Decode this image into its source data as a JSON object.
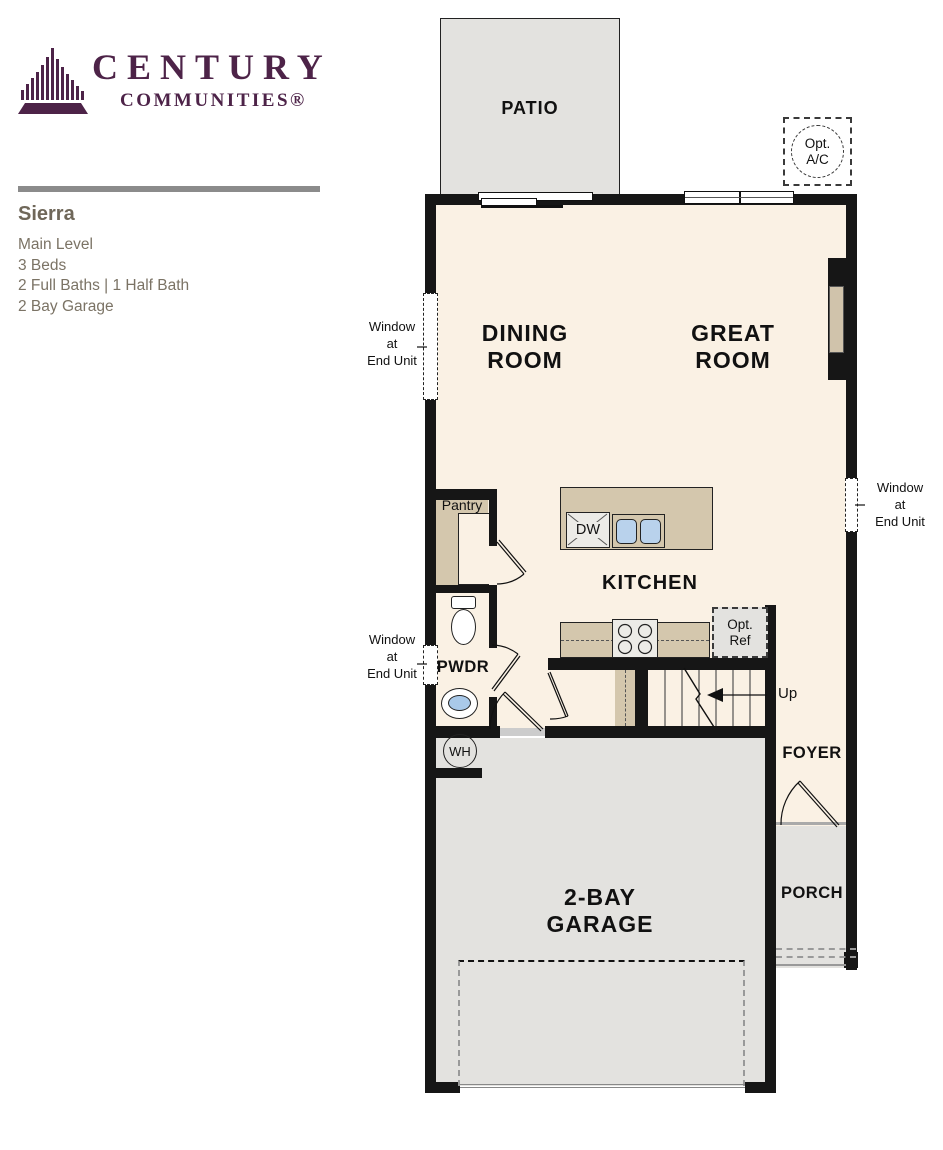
{
  "brand": {
    "line1": "CENTURY",
    "line2": "COMMUNITIES®"
  },
  "plan_info": {
    "title": "Sierra",
    "level": "Main Level",
    "beds": "3 Beds",
    "baths": "2 Full Baths | 1 Half Bath",
    "garage": "2 Bay Garage"
  },
  "rooms": {
    "patio": "PATIO",
    "dining": [
      "DINING",
      "ROOM"
    ],
    "great": [
      "GREAT",
      "ROOM"
    ],
    "kitchen": "KITCHEN",
    "pantry": "Pantry",
    "powder": "PWDR",
    "foyer": "FOYER",
    "porch": "PORCH",
    "garage": [
      "2-BAY",
      "GARAGE"
    ]
  },
  "annotations": {
    "opt_ac": [
      "Opt.",
      "A/C"
    ],
    "opt_ref": [
      "Opt.",
      "Ref"
    ],
    "dishwasher": "DW",
    "water_heater": "WH",
    "stairs_up": "Up",
    "window_end_unit": [
      "Window",
      "at",
      "End Unit"
    ]
  },
  "colors": {
    "brand_purple": "#4d2348",
    "floor_cream": "#faf1e4",
    "concrete_gray": "#e3e2df",
    "cabinet_tan": "#d4c7ad",
    "fixture_blue": "#b9d2ec",
    "wall_black": "#161616",
    "info_text": "#7b7365"
  }
}
